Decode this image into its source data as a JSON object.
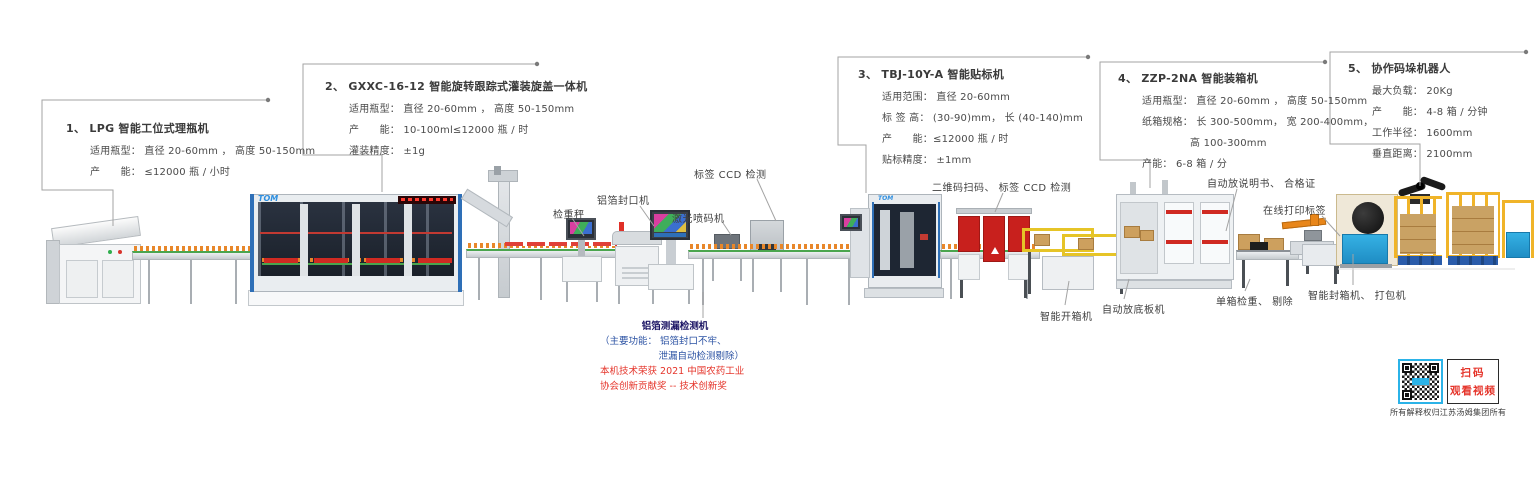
{
  "brand": "TOM",
  "colors": {
    "callout_line": "#a3a3a3",
    "machine_blue": "#2e6fb7",
    "accent_red": "#d02a22",
    "note_navy": "#1b1464",
    "note_blue": "#2b52a3",
    "note_red": "#e5352b",
    "fence_yellow": "#f0b429",
    "strapper_blue": "#35b1e4",
    "qr_border_blue": "#2bb3e8"
  },
  "callouts": [
    {
      "num": "1、",
      "title": "LPG 智能工位式理瓶机",
      "lines": [
        "适用瓶型： 直径 20-60mm ， 高度 50-150mm",
        "产　　能： ≤12000 瓶 / 小时"
      ]
    },
    {
      "num": "2、",
      "title": "GXXC-16-12 智能旋转跟踪式灌装旋盖一体机",
      "lines": [
        "适用瓶型： 直径 20-60mm ， 高度 50-150mm",
        "产　　能： 10-100ml≤12000 瓶 / 时",
        "灌装精度： ±1g"
      ]
    },
    {
      "num": "3、",
      "title": "TBJ-10Y-A 智能贴标机",
      "lines": [
        "适用范围： 直径 20-60mm",
        "标 签 高： (30-90)mm， 长 (40-140)mm",
        "产　　能：≤12000 瓶 / 时",
        "贴标精度： ±1mm"
      ]
    },
    {
      "num": "4、",
      "title": "ZZP-2NA 智能装箱机",
      "lines": [
        "适用瓶型： 直径 20-60mm ， 高度 50-150mm",
        "纸箱规格： 长 300-500mm， 宽 200-400mm，",
        "高 100-300mm",
        "产能： 6-8 箱 / 分"
      ]
    },
    {
      "num": "5、",
      "title": "协作码垛机器人",
      "lines": [
        "最大负载： 20Kg",
        "产　　能： 4-8 箱 / 分钟",
        "工作半径： 1600mm",
        "垂直距离： 2100mm"
      ]
    }
  ],
  "labels": {
    "checkweigher": "检重秤",
    "foil_sealer": "铝箔封口机",
    "label_ccd": "标签 CCD 检测",
    "laser_coder": "激光喷码机",
    "qrcode_ccd": "二维码扫码、 标签 CCD 检测",
    "manual_cert": "自动放说明书、 合格证",
    "online_print": "在线打印标签",
    "case_opener": "智能开箱机",
    "bottom_board": "自动放底板机",
    "box_checkweigh": "单箱检重、 剔除",
    "case_sealer": "智能封箱机、 打包机"
  },
  "leak_note": {
    "title": "铝箔测漏检测机",
    "func_line1": "（主要功能： 铝箔封口不牢、",
    "func_line2": "泄漏自动检测剔除）",
    "award_line1": "本机技术荣获 2021 中国农药工业",
    "award_line2": "协会创新贡献奖 -- 技术创新奖"
  },
  "qr_block": {
    "line1": "扫码",
    "line2": "观看视频",
    "caption": "所有解释权归江苏汤姆集团所有"
  }
}
